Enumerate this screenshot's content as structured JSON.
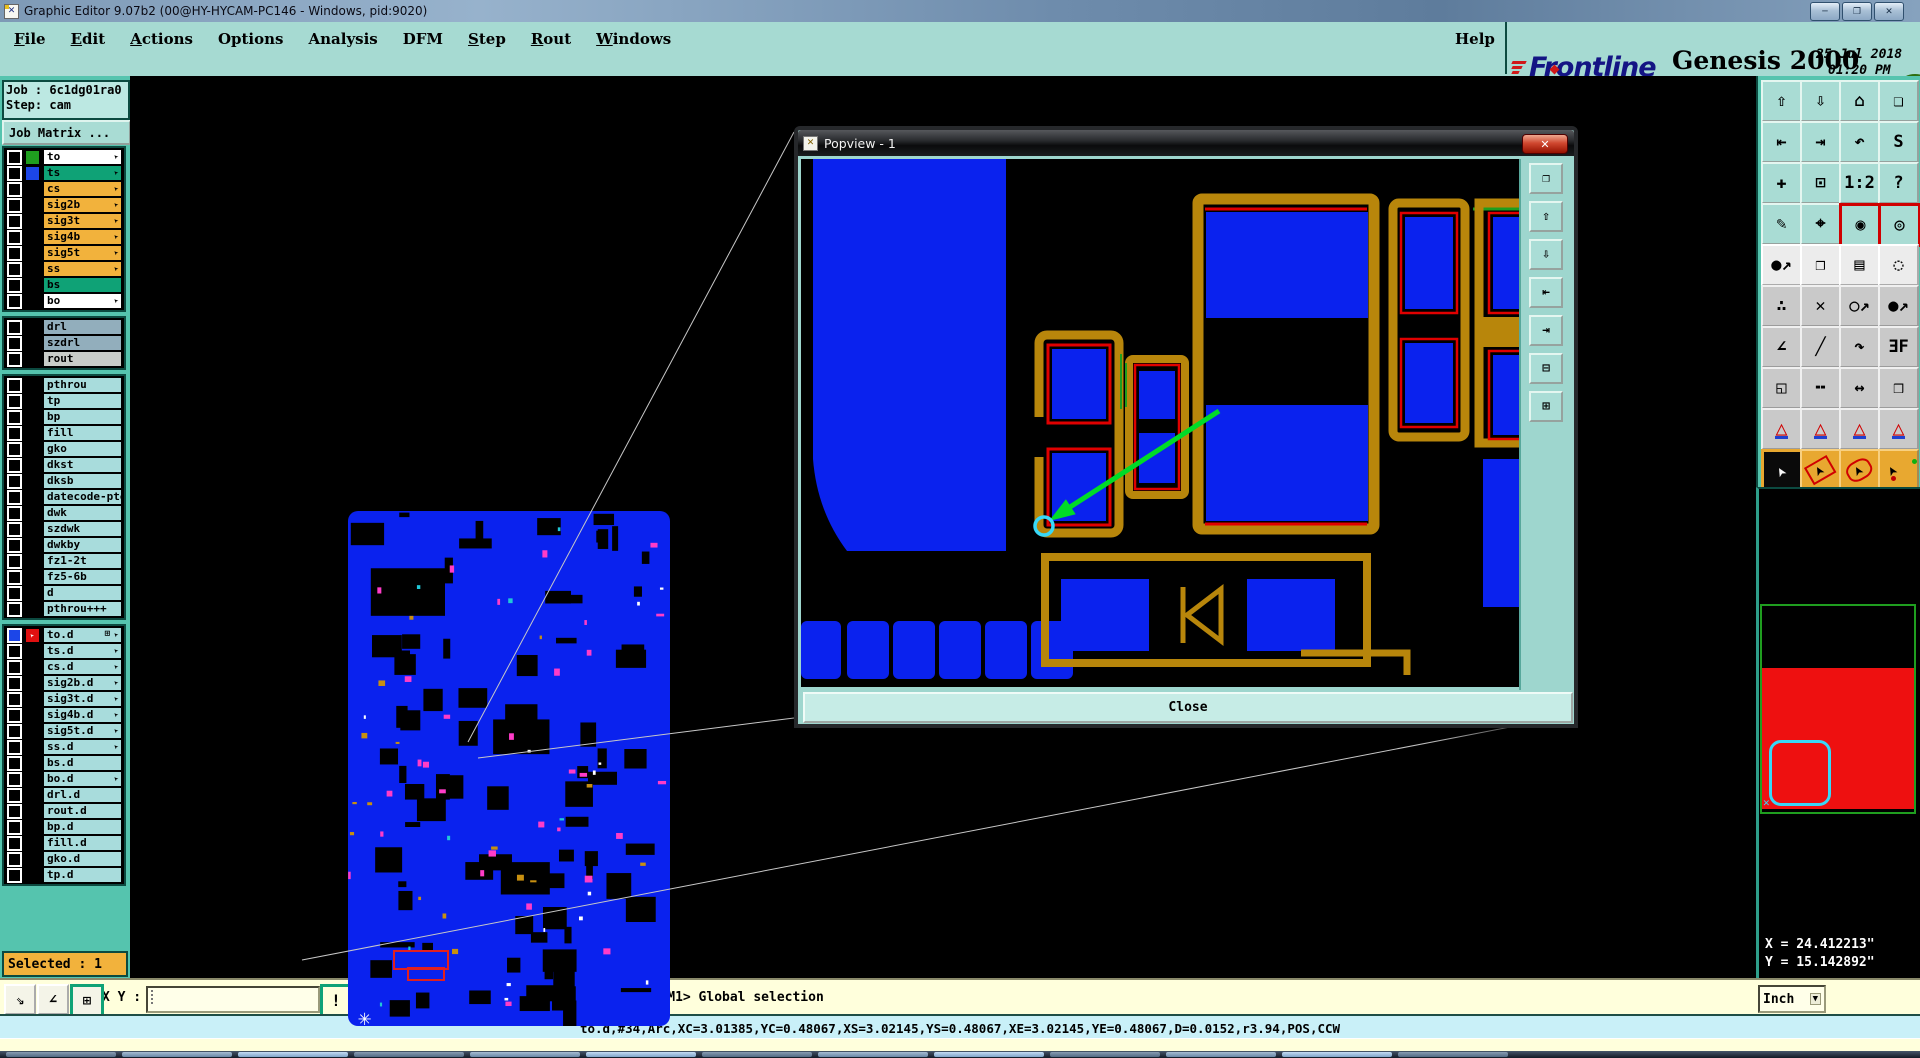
{
  "titlebar": {
    "title": "Graphic Editor 9.07b2 (00@HY-HYCAM-PC146 - Windows, pid:9020)",
    "minimize": "─",
    "restore": "❐",
    "close": "✕"
  },
  "menubar": {
    "items": [
      {
        "label": "File",
        "underline": true
      },
      {
        "label": "Edit",
        "underline": true
      },
      {
        "label": "Actions",
        "underline": true
      },
      {
        "label": "Options",
        "underline": false
      },
      {
        "label": "Analysis",
        "underline": false
      },
      {
        "label": "DFM",
        "underline": false
      },
      {
        "label": "Step",
        "underline": true
      },
      {
        "label": "Rout",
        "underline": true
      },
      {
        "label": "Windows",
        "underline": true
      }
    ],
    "help": "Help"
  },
  "brand": {
    "logo": "Frontline",
    "product": "Genesis 2000",
    "edition": "Graphic Editor",
    "date": "25 Jul 2018",
    "time": "01:20 PM",
    "counter": "67"
  },
  "sidebar": {
    "job": "Job : 6c1dg01ra0",
    "step": "Step: cam",
    "matrix_button": "Job Matrix ...",
    "selected": "Selected : 1",
    "groups": [
      {
        "rows": [
          {
            "name": "to",
            "bg": "#FFFFFF",
            "swatch": "#1F9E1F",
            "arrow": true
          },
          {
            "name": "ts",
            "bg": "#0FA276",
            "swatch": "#1C46E8",
            "arrow": true
          },
          {
            "name": "cs",
            "bg": "#F2B23C",
            "arrow": true
          },
          {
            "name": "sig2b",
            "bg": "#F2B23C",
            "arrow": true
          },
          {
            "name": "sig3t",
            "bg": "#F2B23C",
            "arrow": true
          },
          {
            "name": "sig4b",
            "bg": "#F2B23C",
            "arrow": true
          },
          {
            "name": "sig5t",
            "bg": "#F2B23C",
            "arrow": true
          },
          {
            "name": "ss",
            "bg": "#F2B23C",
            "arrow": true
          },
          {
            "name": "bs",
            "bg": "#0FA276",
            "arrow": false
          },
          {
            "name": "bo",
            "bg": "#FFFFFF",
            "arrow": true
          }
        ]
      },
      {
        "rows": [
          {
            "name": "drl",
            "bg": "#92AEBC",
            "arrow": false
          },
          {
            "name": "szdrl",
            "bg": "#92AEBC",
            "arrow": false
          },
          {
            "name": "rout",
            "bg": "#C9CDC9",
            "arrow": false
          }
        ]
      },
      {
        "rows": [
          {
            "name": "pthrou",
            "bg": "#A8DCDC",
            "arrow": false
          },
          {
            "name": "tp",
            "bg": "#A8DCDC",
            "arrow": false
          },
          {
            "name": "bp",
            "bg": "#A8DCDC",
            "arrow": false
          },
          {
            "name": "fill",
            "bg": "#A8DCDC",
            "arrow": false
          },
          {
            "name": "gko",
            "bg": "#A8DCDC",
            "arrow": false
          },
          {
            "name": "dkst",
            "bg": "#A8DCDC",
            "arrow": false
          },
          {
            "name": "dksb",
            "bg": "#A8DCDC",
            "arrow": false
          },
          {
            "name": "datecode-pte",
            "bg": "#A8DCDC",
            "arrow": false
          },
          {
            "name": "dwk",
            "bg": "#A8DCDC",
            "arrow": false
          },
          {
            "name": "szdwk",
            "bg": "#A8DCDC",
            "arrow": false
          },
          {
            "name": "dwkby",
            "bg": "#A8DCDC",
            "arrow": false
          },
          {
            "name": "fz1-2t",
            "bg": "#A8DCDC",
            "arrow": false
          },
          {
            "name": "fz5-6b",
            "bg": "#A8DCDC",
            "arrow": false
          },
          {
            "name": "d",
            "bg": "#A8DCDC",
            "arrow": false
          },
          {
            "name": "pthrou+++",
            "bg": "#A8DCDC",
            "arrow": false
          }
        ]
      },
      {
        "rows": [
          {
            "name": "to.d",
            "bg": "#A8DCDC",
            "arrow": true,
            "active": true,
            "grid": true
          },
          {
            "name": "ts.d",
            "bg": "#A8DCDC",
            "arrow": true
          },
          {
            "name": "cs.d",
            "bg": "#A8DCDC",
            "arrow": true
          },
          {
            "name": "sig2b.d",
            "bg": "#A8DCDC",
            "arrow": true
          },
          {
            "name": "sig3t.d",
            "bg": "#A8DCDC",
            "arrow": true
          },
          {
            "name": "sig4b.d",
            "bg": "#A8DCDC",
            "arrow": true
          },
          {
            "name": "sig5t.d",
            "bg": "#A8DCDC",
            "arrow": true
          },
          {
            "name": "ss.d",
            "bg": "#A8DCDC",
            "arrow": true
          },
          {
            "name": "bs.d",
            "bg": "#A8DCDC",
            "arrow": false
          },
          {
            "name": "bo.d",
            "bg": "#A8DCDC",
            "arrow": true
          },
          {
            "name": "drl.d",
            "bg": "#A8DCDC",
            "arrow": false
          },
          {
            "name": "rout.d",
            "bg": "#A8DCDC",
            "arrow": false
          },
          {
            "name": "bp.d",
            "bg": "#A8DCDC",
            "arrow": false
          },
          {
            "name": "fill.d",
            "bg": "#A8DCDC",
            "arrow": false
          },
          {
            "name": "gko.d",
            "bg": "#A8DCDC",
            "arrow": false
          },
          {
            "name": "tp.d",
            "bg": "#A8DCDC",
            "arrow": false
          }
        ]
      }
    ]
  },
  "toolbar": {
    "buttons": [
      {
        "name": "paste-up-icon",
        "glyph": "⇧",
        "style": "teal"
      },
      {
        "name": "paste-down-icon",
        "glyph": "⇩",
        "style": "teal"
      },
      {
        "name": "home-view-icon",
        "glyph": "⌂",
        "style": "teal"
      },
      {
        "name": "tile-windows-icon",
        "glyph": "❏",
        "style": "teal"
      },
      {
        "name": "pan-left-icon",
        "glyph": "⇤",
        "style": "teal"
      },
      {
        "name": "pan-right-icon",
        "glyph": "⇥",
        "style": "teal"
      },
      {
        "name": "zoom-previous-icon",
        "glyph": "↶",
        "style": "teal"
      },
      {
        "name": "serpentine-icon",
        "glyph": "S",
        "style": "teal"
      },
      {
        "name": "fit-all-icon",
        "glyph": "✚",
        "style": "teal"
      },
      {
        "name": "zoom-inside-icon",
        "glyph": "⊡",
        "style": "teal"
      },
      {
        "name": "scale-1-2-icon",
        "glyph": "1:2",
        "style": "teal"
      },
      {
        "name": "query-icon",
        "glyph": "?",
        "style": "teal"
      },
      {
        "name": "draw-tools-icon",
        "glyph": "✎",
        "style": "teal"
      },
      {
        "name": "snap-target-icon",
        "glyph": "⌖",
        "style": "teal"
      },
      {
        "name": "net-endpoints-icon",
        "glyph": "◉",
        "style": "teal s-red"
      },
      {
        "name": "net-pads-icon",
        "glyph": "◎",
        "style": "teal s-red"
      },
      {
        "name": "move-feature-icon",
        "glyph": "●↗",
        "style": "s-white"
      },
      {
        "name": "copy-feature-icon",
        "glyph": "❐",
        "style": "s-white"
      },
      {
        "name": "ruler-icon",
        "glyph": "▤",
        "style": "s-white"
      },
      {
        "name": "select-circle-icon",
        "glyph": "◌",
        "style": "s-white"
      },
      {
        "name": "join-features-icon",
        "glyph": "∴",
        "style": "s-gray"
      },
      {
        "name": "delete-feature-icon",
        "glyph": "✕",
        "style": "s-gray"
      },
      {
        "name": "resize-feature-icon",
        "glyph": "○↗",
        "style": "s-gray"
      },
      {
        "name": "move-point-icon",
        "glyph": "●↗",
        "style": "s-gray"
      },
      {
        "name": "angle-line-icon",
        "glyph": "∠",
        "style": "s-gray"
      },
      {
        "name": "diagonal-line-icon",
        "glyph": "╱",
        "style": "s-gray"
      },
      {
        "name": "rotate-icon",
        "glyph": "↷",
        "style": "s-gray"
      },
      {
        "name": "mirror-icon",
        "glyph": "ƎF",
        "style": "s-gray"
      },
      {
        "name": "corner-move-icon",
        "glyph": "◱",
        "style": "s-gray"
      },
      {
        "name": "break-line-icon",
        "glyph": "╍",
        "style": "s-gray"
      },
      {
        "name": "measure-distance-icon",
        "glyph": "↔",
        "style": "s-gray"
      },
      {
        "name": "punch-icon",
        "glyph": "❒",
        "style": "s-gray"
      },
      {
        "name": "fillet-up-icon",
        "glyph": "△",
        "style": "s-tri"
      },
      {
        "name": "fillet-both-icon",
        "glyph": "△",
        "style": "s-tri"
      },
      {
        "name": "fillet-base-icon",
        "glyph": "△",
        "style": "s-tri"
      },
      {
        "name": "fillet-ends-icon",
        "glyph": "△",
        "style": "s-tri"
      },
      {
        "name": "select-single-cursor-icon",
        "glyph": "➤",
        "style": "s-cur s-cur-active"
      },
      {
        "name": "select-rect-cursor-icon",
        "glyph": "➤",
        "style": "s-cur s-cur-red"
      },
      {
        "name": "select-poly-cursor-icon",
        "glyph": "➤",
        "style": "s-cur s-cur-oct"
      },
      {
        "name": "select-net-cursor-icon",
        "glyph": "➤",
        "style": "s-cur s-cur-net"
      }
    ]
  },
  "popview": {
    "title": "Popview - 1",
    "close_x": "✕",
    "close_button": "Close",
    "side_buttons": [
      {
        "name": "popout-icon",
        "glyph": "❐"
      },
      {
        "name": "view-up-icon",
        "glyph": "⇧"
      },
      {
        "name": "view-down-icon",
        "glyph": "⇩"
      },
      {
        "name": "pan-left-icon",
        "glyph": "⇤"
      },
      {
        "name": "pan-right-icon",
        "glyph": "⇥"
      },
      {
        "name": "zoom-out-icon",
        "glyph": "⊟"
      },
      {
        "name": "zoom-in-icon",
        "glyph": "⊞"
      }
    ]
  },
  "rightpanel": {
    "coord_x": "X = 24.412213\"",
    "coord_y": "Y = 15.142892\"",
    "units": "Inch",
    "units_arrow": "▼",
    "overview_cross": "✕"
  },
  "bottombar": {
    "tools": [
      {
        "name": "pan-zoom-mode-icon",
        "glyph": "⇘",
        "active": false
      },
      {
        "name": "measure-mode-icon",
        "glyph": "∠",
        "active": false
      },
      {
        "name": "grid-windows-icon",
        "glyph": "⊞",
        "active": true
      }
    ],
    "xy_label": "X Y :",
    "input_value": "",
    "alert": "!",
    "message": "<M1> - Single feature selection ; <M1><M1> Global selection"
  },
  "statusbar": {
    "text": "to.d,#34,Arc,XC=3.01385,YC=0.48067,XS=3.02145,YS=0.48067,XE=3.02145,YE=0.48067,D=0.0152,r3.94,POS,CCW"
  },
  "canvas_marker": {
    "star": "✳"
  },
  "colors": {
    "teal_panel": "#55C4AE",
    "header_teal": "#A6DAD2",
    "amber": "#F2B23C",
    "row_green": "#0FA276",
    "light_cyan": "#A8DCDC",
    "board_blue": "#0A22EE",
    "trace_gold": "#B8860B",
    "alert_red": "#E00000",
    "highlight_cyan": "#38D8F8",
    "select_green": "#00DC28",
    "cream": "#FFFFDC",
    "status_cyan": "#C9F0F8"
  }
}
